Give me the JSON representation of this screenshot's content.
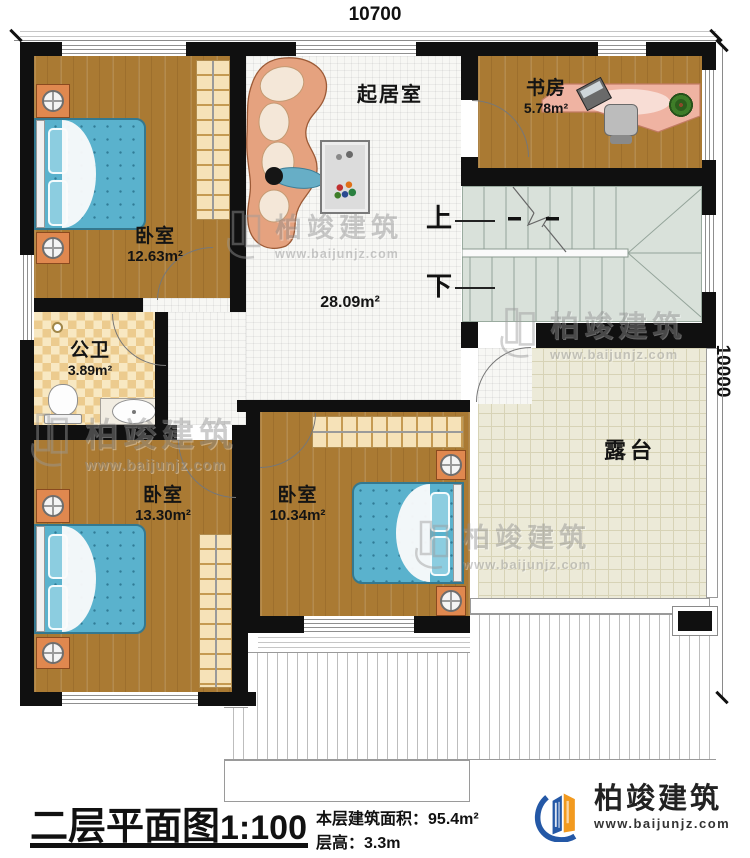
{
  "dimensions": {
    "top": "10700",
    "right": "10000"
  },
  "rooms": {
    "bedroom_top_left": {
      "label": "卧室",
      "area": "12.63m²"
    },
    "living_room": {
      "label": "起居室",
      "area": "28.09m²"
    },
    "study": {
      "label": "书房",
      "area": "5.78m²"
    },
    "bathroom": {
      "label": "公卫",
      "area": "3.89m²"
    },
    "bedroom_bottom_left": {
      "label": "卧室",
      "area": "13.30m²"
    },
    "bedroom_bottom_middle": {
      "label": "卧室",
      "area": "10.34m²"
    },
    "terrace": {
      "label": "露台"
    }
  },
  "stairs": {
    "up_label": "上",
    "down_label": "下"
  },
  "watermark": {
    "brand": "柏竣建筑",
    "url": "www.baijunjz.com"
  },
  "logo": {
    "brand": "柏竣建筑",
    "url": "www.baijunjz.com"
  },
  "title_block": {
    "title": "二层平面图",
    "scale": "1:100",
    "area_label": "本层建筑面积：",
    "area_value": "95.4m²",
    "height_label": "层高：",
    "height_value": "3.3m"
  },
  "colors": {
    "wall": "#101010",
    "wood_floor": "#aa7a33",
    "terrace_floor": "#ecead8",
    "stairs_floor": "#d9e1da",
    "bed": "#5ab2cd",
    "logo_blue": "#2458a6",
    "logo_orange": "#f29a1f"
  }
}
